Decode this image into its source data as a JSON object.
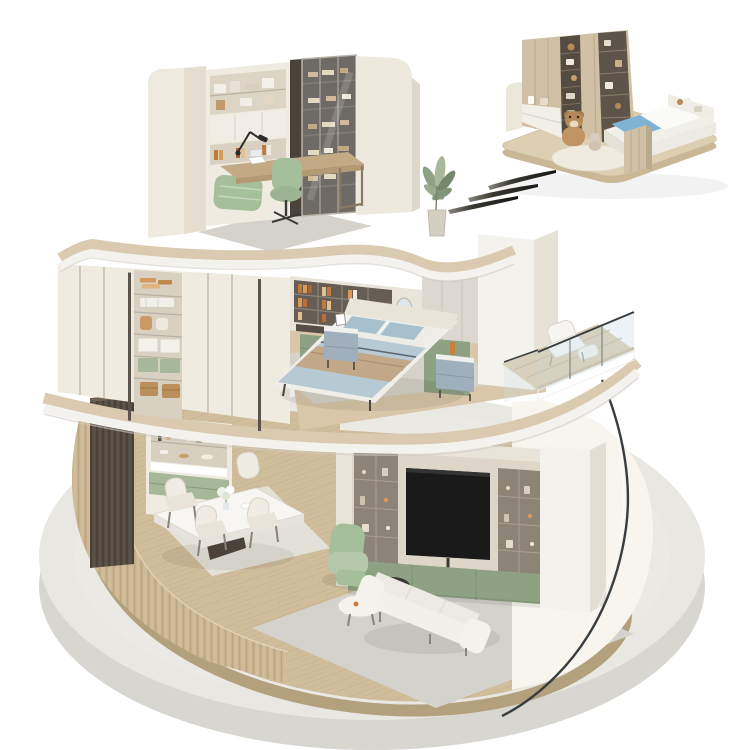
{
  "meta": {
    "description": "Isometric 3D cutaway render of a three-storey round smart-home model with a detached children's bedroom module floating at the top right and three dark motion strokes between them",
    "canvas": {
      "width": 750,
      "height": 750
    }
  },
  "palette": {
    "concrete_top": "#e9e7e2",
    "concrete_side": "#d8d6d0",
    "wood_floor": "#cfbd9b",
    "wood_floor_side": "#b3a07c",
    "plank_line": "#a98f68",
    "slat_wood": "#cdb794",
    "slab_wood": "#d9cab0",
    "slab_fascia": "#f3f2ee",
    "wall_cream": "#e9e4da",
    "wall_white": "#f4f2ec",
    "cabinet_cream": "#efebe1",
    "shelf_interior": "#8d8478",
    "shelf_dark": "#665e54",
    "sage": "#a7b79a",
    "sage_dark": "#8fa183",
    "tv_black": "#1a1a1a",
    "glass_line": "#383d40",
    "bed_blue": "#b7c9d3",
    "pillow_blue": "#a6c0cd",
    "throw_tan": "#c2a789",
    "mattress_white": "#edece6",
    "nightstand_blue": "#9fb0bc",
    "chair_green": "#a6bf9b",
    "chair_tan": "#c8904f",
    "dark_wood": "#564d44",
    "desk_wood": "#c4aa84",
    "ivory_wall": "#f7f5ee",
    "rug_gray": "#d4d2cc",
    "rug_light": "#e4e2da",
    "module_wood": "#cfc0a6",
    "stroke_dark": "#2a2923",
    "kid_blanket_blue": "#7fb3d4",
    "teddy_brown": "#b58a58"
  },
  "scene": {
    "base": {
      "name": "round-concrete-platform"
    },
    "floors": [
      {
        "name": "ground-floor-living-dining",
        "objects": [
          "curved-slat-wall",
          "slatted-divider-panel",
          "dining-cabinet",
          "dining-table",
          "dining-chairs",
          "flower-vase",
          "media-wall",
          "tv",
          "display-shelves",
          "green-base-cabinet",
          "green-armchair",
          "coffee-tables",
          "white-sofa",
          "area-rugs",
          "curved-ivory-wall",
          "curved-glass-screen"
        ]
      },
      {
        "name": "middle-floor-bedroom",
        "objects": [
          "walk-in-wardrobe",
          "folded-clothes",
          "storage-boxes",
          "bookshelf-vanity",
          "vanity-chair",
          "double-bed",
          "pillows",
          "throw-blanket",
          "nightstands",
          "laundry-nook",
          "washing-machine",
          "towel-shelf",
          "balcony",
          "glass-railing",
          "lounge-chair"
        ]
      },
      {
        "name": "top-floor-study",
        "objects": [
          "curved-white-walls",
          "bookshelf-wall",
          "glass-display-cabinet",
          "desk",
          "desk-lamp",
          "laptop",
          "office-chair",
          "green-daybed",
          "rug",
          "potted-plant"
        ]
      }
    ],
    "floating_module": {
      "name": "kids-bedroom-module",
      "objects": [
        "panel-wardrobe",
        "open-toy-shelves",
        "white-drawer-base",
        "platform-bed",
        "blue-blanket",
        "teddy-bears",
        "round-rug",
        "wood-base-slab"
      ]
    },
    "motion_strokes": {
      "count": 3
    }
  }
}
